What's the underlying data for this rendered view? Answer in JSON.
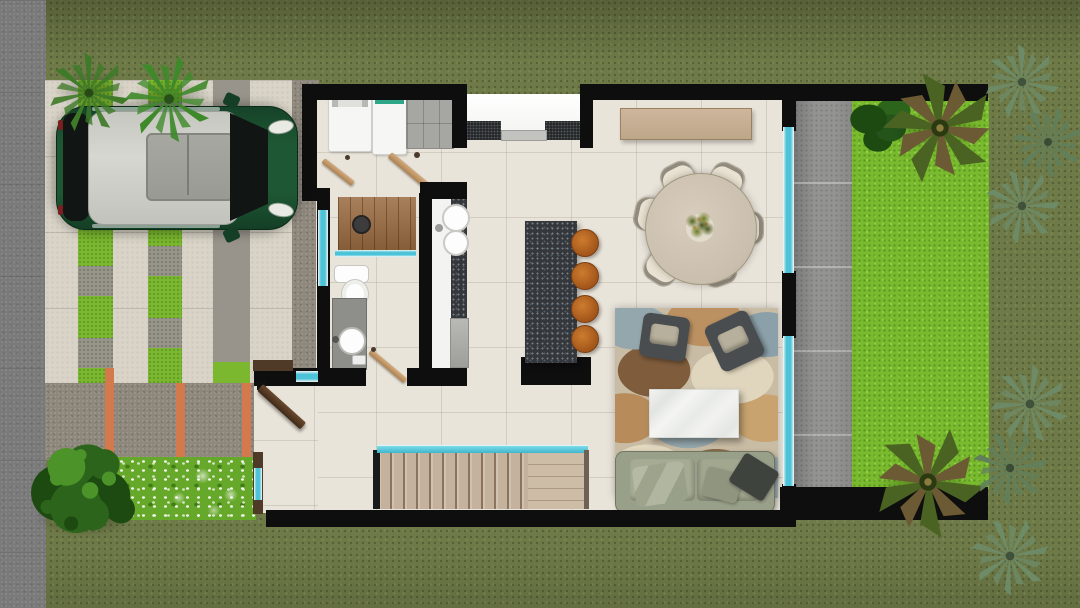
{
  "scene": {
    "type": "3d-floor-plan-top-view",
    "description": "Top-down 3D render of a single-family house ground floor with street sidewalk, paver driveway with parked green car, front garden, open-plan laundry/bathroom/kitchen/dining/living interior, stairs, rear glass wall, concrete patio and bright backyard lawn with palms"
  },
  "palette": {
    "grass-olive": "#6e7a48",
    "grass-lawn": "#79ba2e",
    "sidewalk": "#7a7a7a",
    "paver-light": "#d9d4c7",
    "paver-gray": "#99948b",
    "paver-grass": "#7cb82f",
    "walkway": "#8d877c",
    "stripe-orange": "#d3794b",
    "wall": "#0e0e0e",
    "floor-tile": "#e9e4da",
    "floor-porch": "#fafaf8",
    "glass": "#4cc3d8",
    "patio": "#939392",
    "wood-door": "#c59d76",
    "wood-front-door": "#543723",
    "wood-floor": "#9a6b40",
    "stairs-wood": "#c4b29c",
    "stairs-landing": "#cdbda6",
    "car-body": "#1b4c2b",
    "car-roof": "#cccdc6",
    "car-sunroof": "#9fa09a",
    "car-glass": "#111513",
    "island-granite": "#34373c",
    "counter-white": "#f3f3f1",
    "stool-orange": "#b5651f",
    "table-wood": "#cfc3b1",
    "sideboard-wood": "#c2ab92",
    "chair-cream": "#eae3d3",
    "rug-base": "#c9bca4",
    "sofa-green": "#99a089",
    "armchair-gray": "#4a4d50",
    "marble": "#eff0ee",
    "vanity-gray": "#8e8e8a",
    "fixture-white": "#fdfdfd",
    "appliance-white": "#f6f6f5",
    "cabinet-gray": "#a6a6a2",
    "mat-dark": "#26292b",
    "plant-green": "#3e7a28",
    "palm-green": "#4a6323",
    "palm-brown": "#6b5a33",
    "yucca-green": "#6e8b68",
    "bush-dark": "#1d4a10",
    "bush-mid": "#2b641a",
    "bush-light": "#4c9329",
    "flower-green": "#66a82a"
  },
  "exterior": {
    "sidewalk": "street sidewalk strip",
    "driveway": {
      "surface": "light concrete slab pavers",
      "inlays": [
        "grass strip squares",
        "gray paver squares"
      ],
      "orange_accent_stripes": 3
    },
    "vehicle": {
      "kind": "compact hatchback car, top view",
      "body_color_key": "car-body",
      "roof": "silver with sunroof"
    },
    "driveway_plants": 2,
    "front_garden": {
      "shrub": "round leafy shrub",
      "flower_bed": "white flowers over grass"
    },
    "backyard": {
      "lawn": "bright mowed lawn",
      "patio": "gray concrete slab walkway",
      "palm_trees": 2,
      "yucca_plants": 6,
      "hedge": "dark green hedge"
    }
  },
  "interior": {
    "laundry": {
      "appliances": [
        "washing machine",
        "dryer"
      ],
      "cabinet": "gray storage cabinet",
      "open_doors": 2
    },
    "entry_top": {
      "porch": "recessed white entry",
      "doormats": 2,
      "threshold": 1
    },
    "bathroom": {
      "shower_deck": "wood slat deck",
      "glass_partitions": 2,
      "toilet": 1,
      "vanity_with_round_sink": 1,
      "open_door": 1
    },
    "kitchen": {
      "counter": "counter run with double sink and cooktop",
      "island": "dark granite island",
      "bar_stools": 4
    },
    "dining": {
      "sideboard": "wood sideboard",
      "table": "round dining table",
      "centerpiece": "table plant",
      "chairs": 6
    },
    "living": {
      "rug": "abstract patterned area rug",
      "armchairs": 2,
      "coffee_table": "white marble coffee table",
      "sofa": "two-cushion sofa",
      "throw_pillows": 3
    },
    "stairs": {
      "treads": "wood stair treads",
      "landing": "wood landing",
      "railing": "teal glass railing"
    },
    "entry_left": {
      "front_door": "dark wood door shown open",
      "side_window": "glass slot window"
    },
    "structure": {
      "walls": "black poche walls",
      "rear_glass_walls": 2
    }
  }
}
